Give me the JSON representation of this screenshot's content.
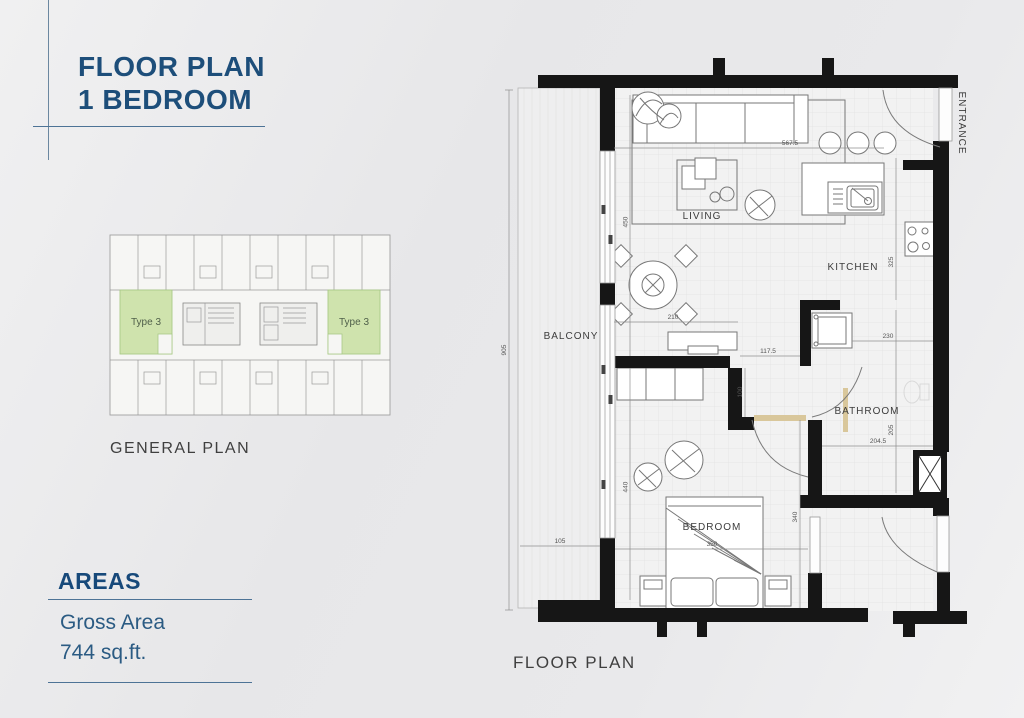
{
  "title": {
    "line1": "FLOOR PLAN",
    "line2": "1 BEDROOM",
    "accent_color": "#1d4e7a"
  },
  "general_plan": {
    "caption": "GENERAL PLAN",
    "unit_label_left": "Type 3",
    "unit_label_right": "Type 3",
    "highlight_color": "#cfe3ad"
  },
  "areas": {
    "heading": "AREAS",
    "gross_area_label": "Gross Area",
    "gross_area_value": "744 sq.ft."
  },
  "floor_plan": {
    "caption": "FLOOR PLAN",
    "rooms": {
      "living": "LIVING",
      "kitchen": "KITCHEN",
      "balcony": "BALCONY",
      "bathroom": "BATHROOM",
      "bedroom": "BEDROOM",
      "entrance": "ENTRANCE"
    },
    "dimensions": {
      "overall_height": "905",
      "living_depth": "450",
      "living_width": "567.5",
      "dining_width": "210",
      "opening_width": "117.5",
      "doorway_width": "100",
      "hall_width": "230",
      "kitchen_depth": "325",
      "bathroom_depth": "205",
      "bathroom_width": "204.5",
      "bedroom_zone_depth": "440",
      "bedroom_depth": "340",
      "balcony_width": "105",
      "bedroom_width": "350"
    }
  }
}
